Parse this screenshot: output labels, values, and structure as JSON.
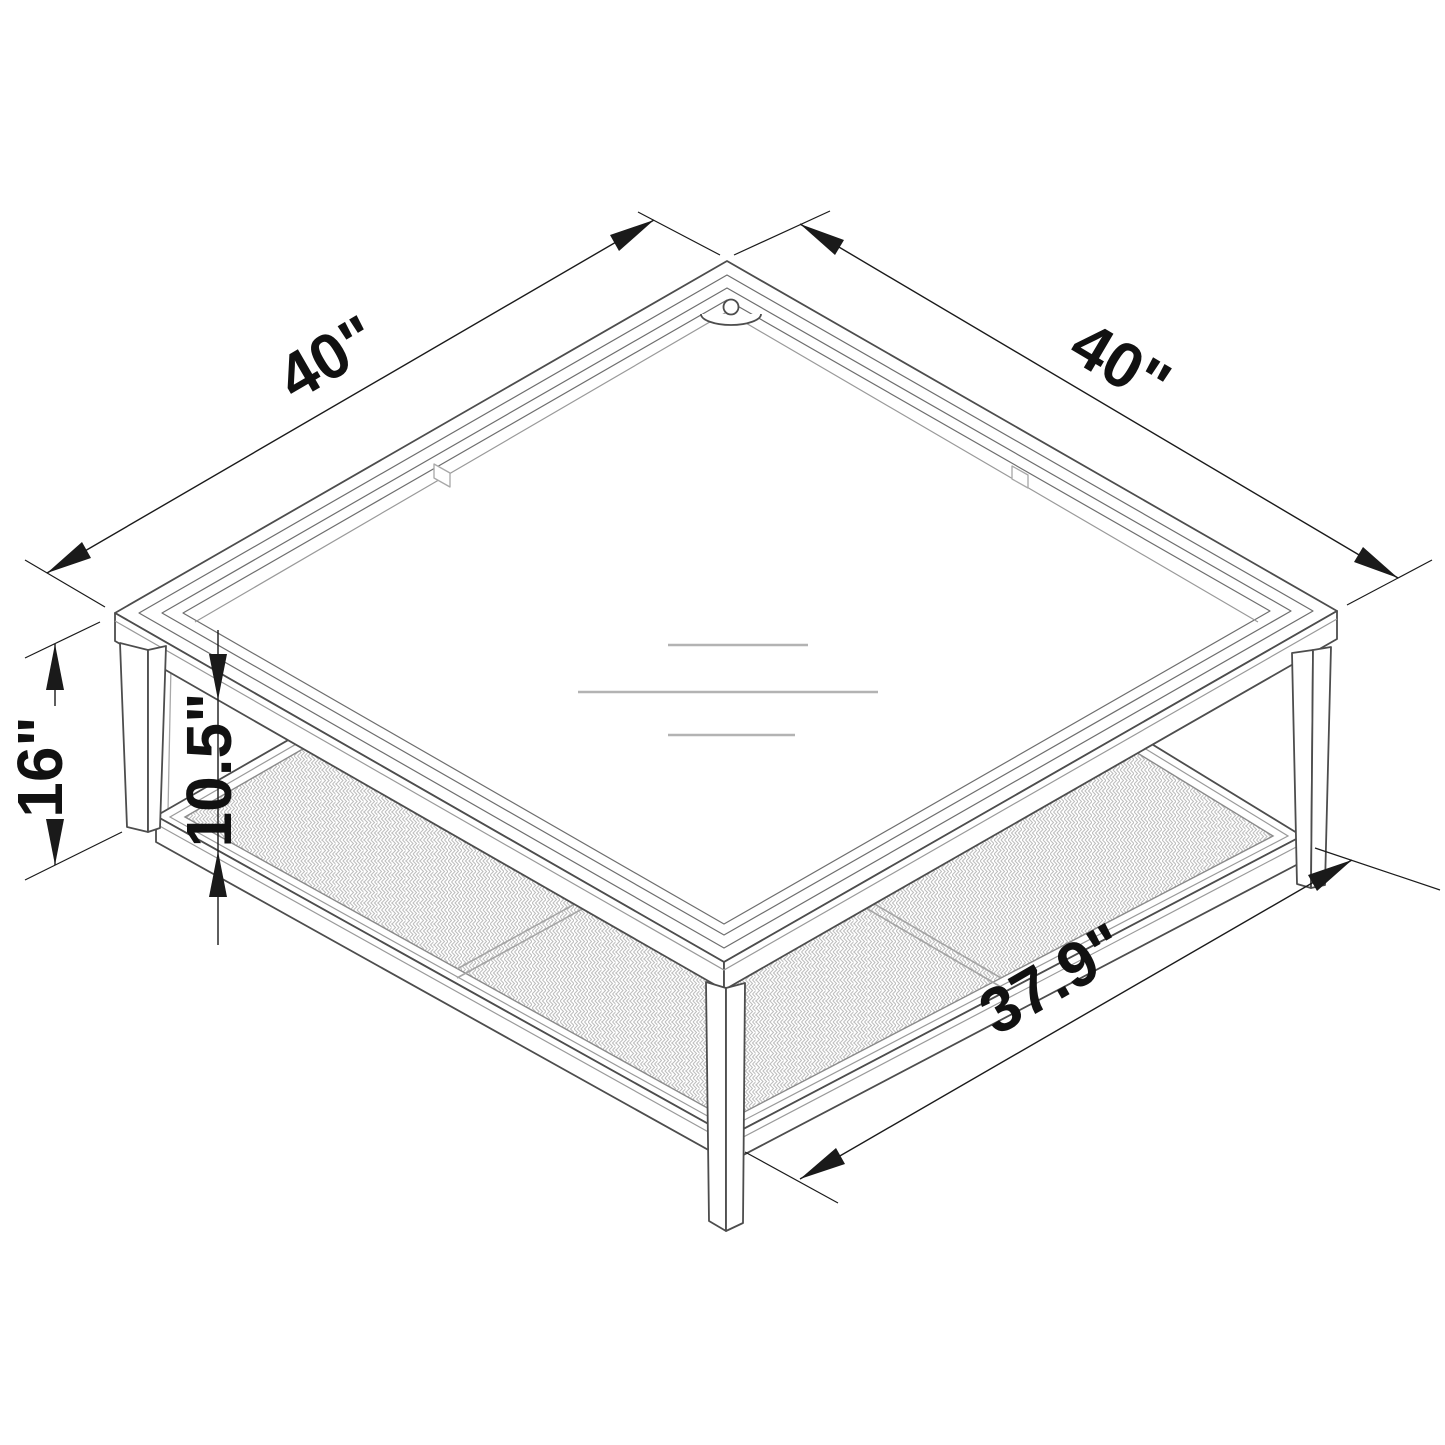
{
  "diagram": {
    "title": "Square coffee table isometric dimension drawing",
    "subject": "glass-top coffee table with woven cane lower shelf and tapered legs",
    "style": "black-and-white technical line drawing",
    "background_color": "#ffffff",
    "line_color": "#4d4d4d",
    "dimension_color": "#1a1a1a",
    "dimensions": {
      "top_edge_left": "40\"",
      "top_edge_right": "40\"",
      "overall_height": "16\"",
      "shelf_clearance": "10.5\"",
      "shelf_width": "37.9\""
    }
  }
}
